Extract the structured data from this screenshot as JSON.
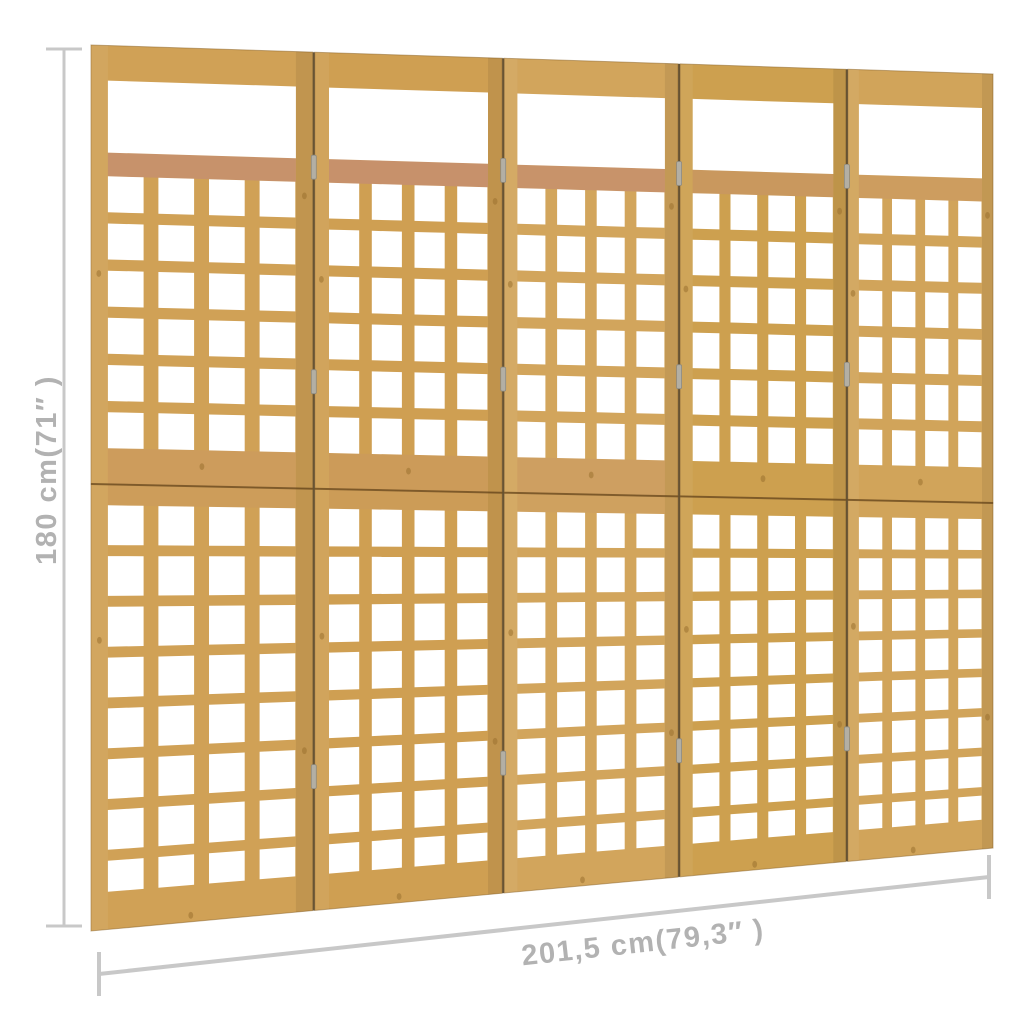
{
  "diagram": {
    "type": "product-dimension-diagram",
    "background": "#ffffff",
    "height_label": "180 cm(71″ )",
    "width_label": "201,5 cm(79,3″ )",
    "annotation": {
      "line_color": "#c8c8c8",
      "text_color": "#b2b2b2"
    }
  },
  "trellis": {
    "object": "5-panel wooden trellis room divider",
    "panels": 5,
    "upper_grid": {
      "rows": 6,
      "cols": 4
    },
    "lower_grid": {
      "rows": 8,
      "cols": 4
    },
    "palette": {
      "wood_faces": [
        "#d0a156",
        "#cf9f52",
        "#d2a55c",
        "#cda04f",
        "#d1a45a"
      ],
      "wood_edge": "#8a6226",
      "panel_gap": "#513a16",
      "seam": "#6d4c20",
      "rail_tint": "#c58f6e",
      "hinge": "#b3afa4",
      "knot": "#9a7130",
      "hole": "#ffffff"
    }
  }
}
